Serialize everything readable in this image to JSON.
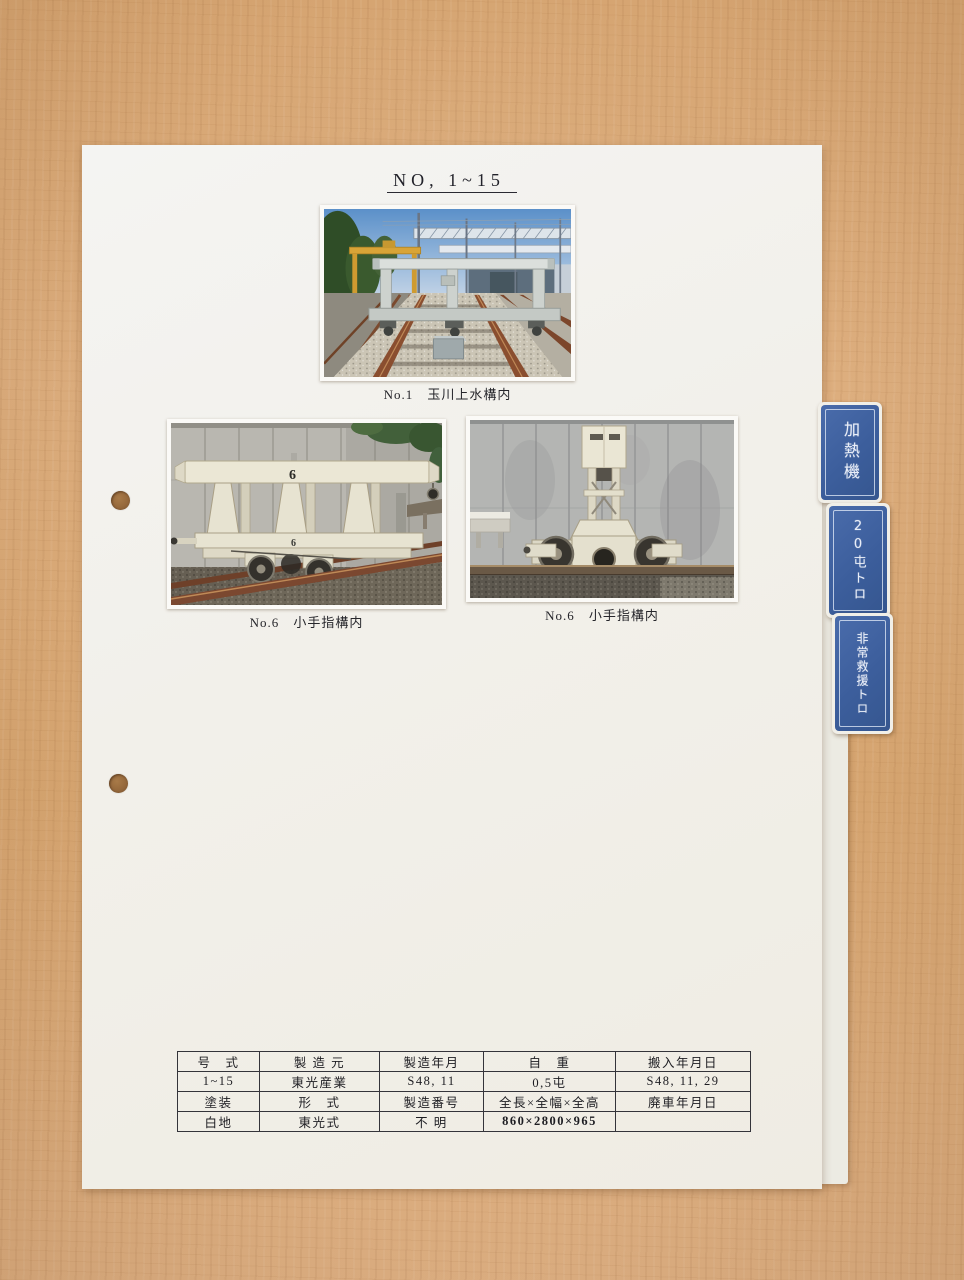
{
  "page": {
    "title": "NO, 1~15"
  },
  "photos": [
    {
      "caption_no": "No.1",
      "caption_place": "玉川上水構内"
    },
    {
      "caption_no": "No.6",
      "caption_place": "小手指構内",
      "unit_number": "6"
    },
    {
      "caption_no": "No.6",
      "caption_place": "小手指構内"
    }
  ],
  "index_tabs": [
    {
      "label": "加熱機"
    },
    {
      "label": "20屯トロ"
    },
    {
      "label": "非常救援トロ"
    }
  ],
  "spec_table": {
    "rows": [
      [
        "号　式",
        "製 造 元",
        "製造年月",
        "自　重",
        "搬入年月日"
      ],
      [
        "1~15",
        "東光産業",
        "S48, 11",
        "0,5屯",
        "S48, 11, 29"
      ],
      [
        "塗装",
        "形　式",
        "製造番号",
        "全長×全幅×全高",
        "廃車年月日"
      ],
      [
        "白地",
        "東光式",
        "不 明",
        "860×2800×965",
        ""
      ]
    ]
  },
  "colors": {
    "tab_blue": "#3c5e9c",
    "paper": "#f2f0ea",
    "wood": "#d9a876"
  }
}
